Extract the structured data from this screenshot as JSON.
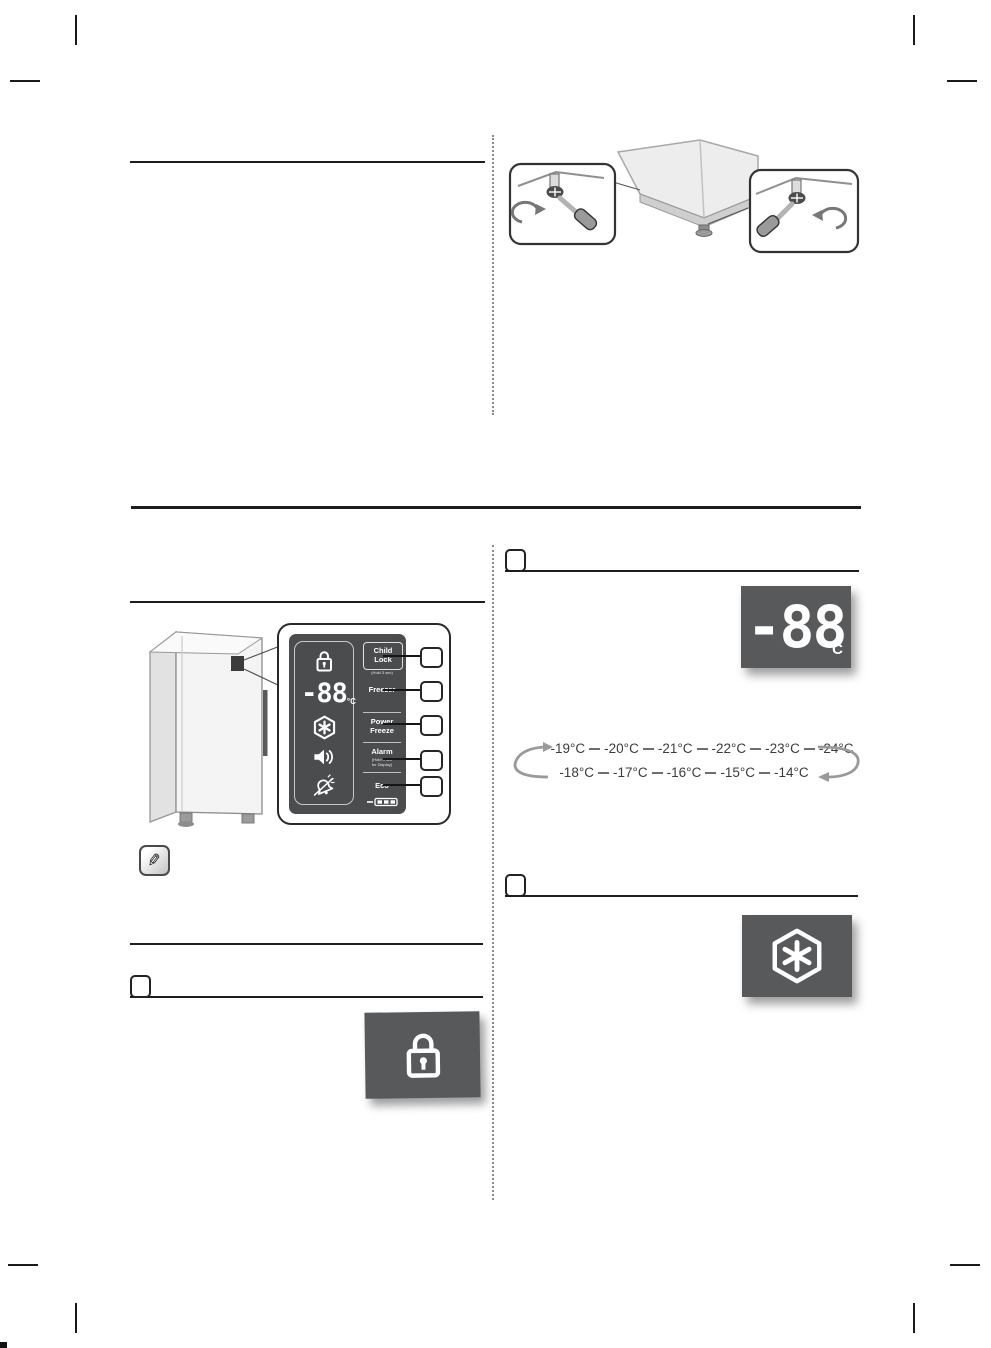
{
  "colors": {
    "display_box_bg": "#58595B",
    "panel_bg": "#4B4C4E",
    "arrow_gray": "#999999",
    "line_black": "#1d1d1d"
  },
  "icons": {
    "note": "✎",
    "display_lock": "padlock-icon",
    "power_freeze": "snowflake-hexagon-icon",
    "alarm": "speaker-icon",
    "door_alarm_off": "door-alarm-off-icon"
  },
  "control_panel": {
    "display": {
      "value": "-88",
      "unit": "°C"
    },
    "buttons": [
      {
        "label": "Child Lock",
        "sublabel": "(Hold 3 sec)"
      },
      {
        "label": "Freezer",
        "sublabel": ""
      },
      {
        "label": "Power Freeze",
        "sublabel": ""
      },
      {
        "label": "Alarm",
        "sublabel_line1": "(Hold 3 sec",
        "sublabel_line2": "for Display)"
      },
      {
        "label": "Eco",
        "sublabel": ""
      }
    ]
  },
  "freezer_display_box": {
    "value": "-88",
    "unit": "°C"
  },
  "temperature_cycle": {
    "row1": [
      "-19°C",
      "-20°C",
      "-21°C",
      "-22°C",
      "-23°C",
      "-24°C"
    ],
    "row2": [
      "-18°C",
      "-17°C",
      "-16°C",
      "-15°C",
      "-14°C"
    ]
  }
}
